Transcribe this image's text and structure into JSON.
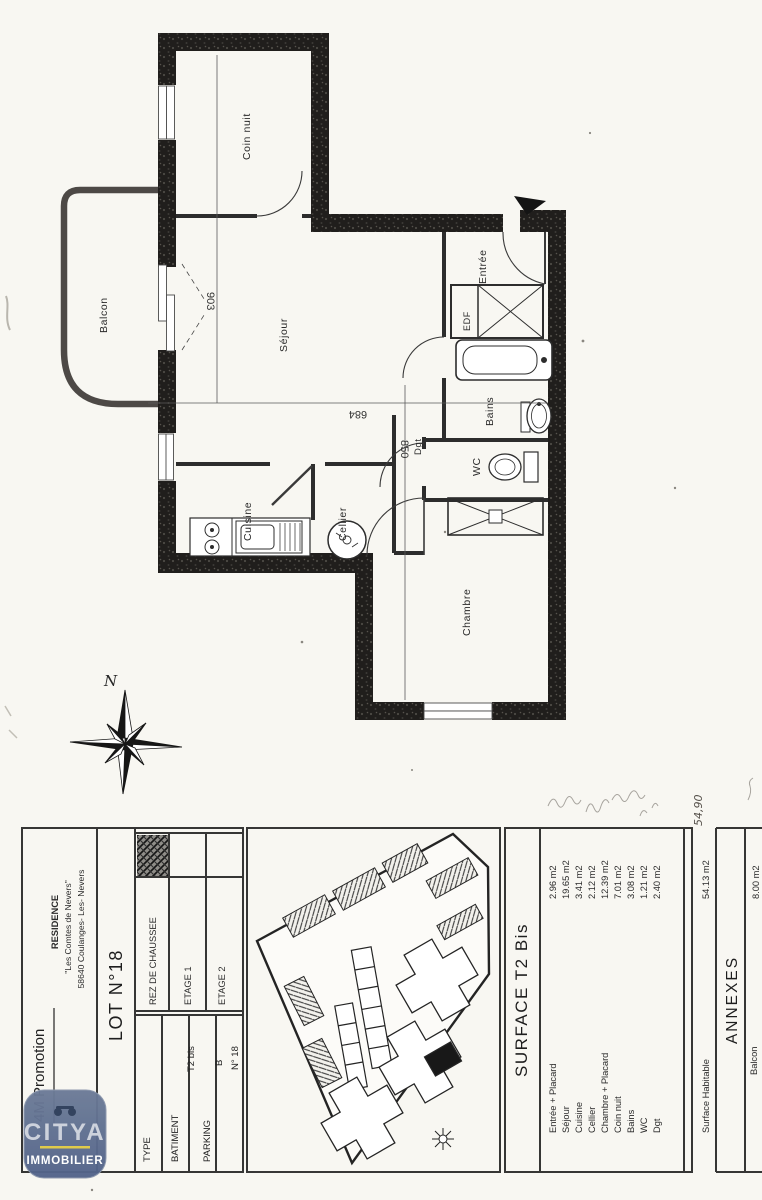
{
  "plan": {
    "rooms": {
      "coin_nuit": "Coin nuit",
      "balcon": "Balcon",
      "sejour": "Séjour",
      "entree": "Entrée",
      "edf": "EDF",
      "bains": "Bains",
      "wc": "WC",
      "dgt": "Dgt",
      "chambre": "Chambre",
      "cuisine": "Cuisine",
      "cellier": "Cellier"
    },
    "dimensions": {
      "d903": "903",
      "d684": "684",
      "d850": "850"
    },
    "compass_north": "N"
  },
  "title_block": {
    "promoter": "4M Promotion",
    "residence_line1": "RESIDENCE",
    "residence_line2": "\"Les Comtes de Nevers\"",
    "residence_line3": "58640 Coulanges- Les- Nevers",
    "lot": "LOT N°18",
    "floors": {
      "rdc": "REZ DE CHAUSSEE",
      "etage1": "ETAGE 1",
      "etage2": "ETAGE 2"
    },
    "type": {
      "label": "TYPE",
      "value": "T2 bis"
    },
    "batiment": {
      "label": "BATIMENT",
      "value": "B"
    },
    "parking": {
      "label": "PARKING",
      "value": "N° 18"
    }
  },
  "logo": {
    "brand": "CITYA",
    "tagline": "IMMOBILIER",
    "colors": {
      "shield_blue": "#5d6e8e",
      "accent_yellow": "#e0cb4a"
    }
  },
  "surface_table": {
    "title": "SURFACE  T2 Bis",
    "rows": [
      {
        "name": "Entrée + Placard",
        "area": "2.96 m2"
      },
      {
        "name": "Séjour",
        "area": "19.65 m2"
      },
      {
        "name": "Cuisine",
        "area": "3.41 m2"
      },
      {
        "name": "Cellier",
        "area": "2.12 m2"
      },
      {
        "name": "Chambre + Placard",
        "area": "12.39 m2"
      },
      {
        "name": "Coin nuit",
        "area": "7.01 m2"
      },
      {
        "name": "Bains",
        "area": "3.08 m2"
      },
      {
        "name": "WC",
        "area": "1.21 m2"
      },
      {
        "name": "Dgt",
        "area": "2.40 m2"
      }
    ],
    "habitable_label": "Surface Habitable",
    "habitable_value": "54.13 m2",
    "annexes_title": "ANNEXES",
    "annexe_name": "Balcon",
    "annexe_value": "8.00 m2"
  },
  "handwriting": {
    "note": "54,90"
  }
}
